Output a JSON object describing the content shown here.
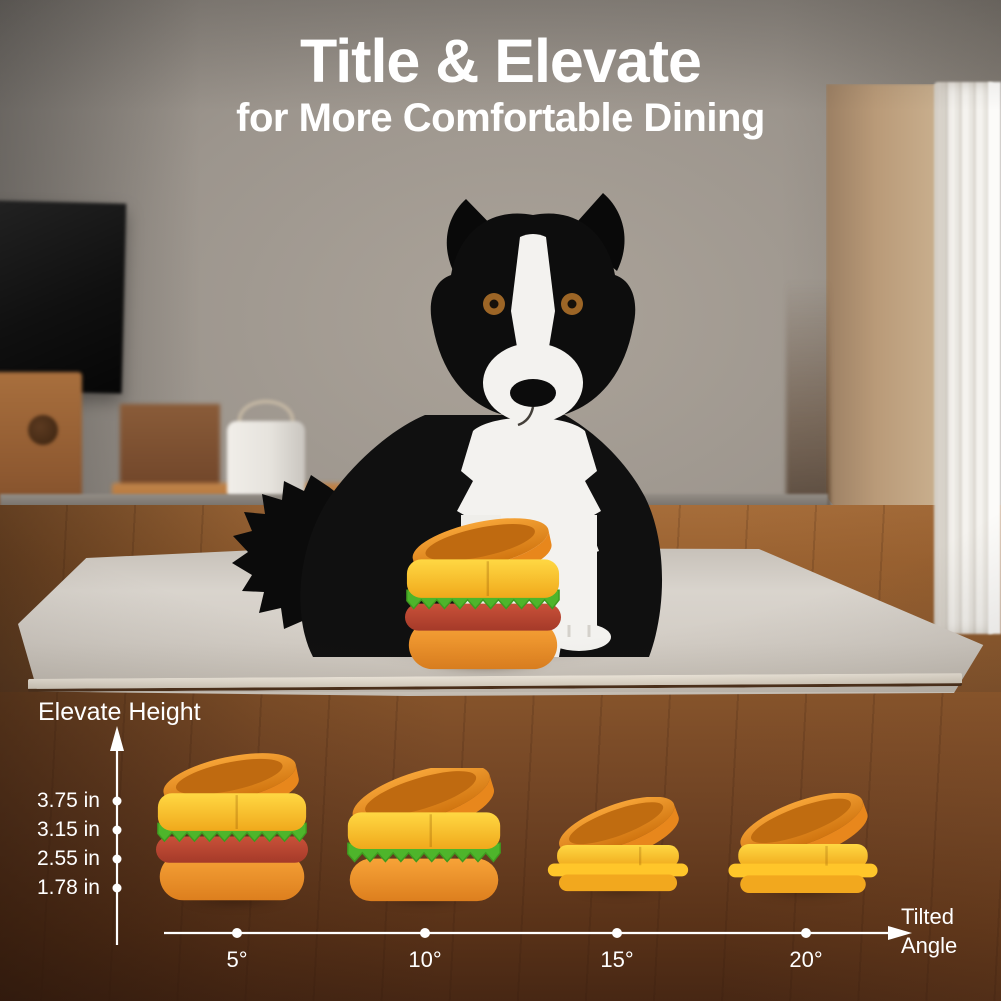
{
  "page": {
    "title": "Title & Elevate",
    "subtitle": "for More Comfortable Dining"
  },
  "chart": {
    "ylabel": "Elevate Height",
    "xlabel_line1": "Tilted",
    "xlabel_line2": "Angle",
    "y_ticks": [
      "3.75 in",
      "3.15 in",
      "2.55 in",
      "1.78 in"
    ],
    "x_ticks": [
      "5°",
      "10°",
      "15°",
      "20°"
    ]
  },
  "chart_data": {
    "type": "scatter",
    "title": "Elevate Height vs Tilted Angle of hamburger-shaped elevated dog bowl",
    "xlabel": "Tilted Angle",
    "ylabel": "Elevate Height",
    "x_categories": [
      "5°",
      "10°",
      "15°",
      "20°"
    ],
    "y_tick_labels": [
      "3.75 in",
      "3.15 in",
      "2.55 in",
      "1.78 in"
    ],
    "points": [
      {
        "tilted_angle": "5°",
        "elevate_height_in": 3.75,
        "bowl_style": "burger with lettuce and patty"
      },
      {
        "tilted_angle": "10°",
        "elevate_height_in": 3.15,
        "bowl_style": "burger with lettuce"
      },
      {
        "tilted_angle": "15°",
        "elevate_height_in": 2.55,
        "bowl_style": "plain yellow tilted bowl"
      },
      {
        "tilted_angle": "20°",
        "elevate_height_in": 1.78,
        "bowl_style": "plain yellow tilted bowl"
      }
    ],
    "axis_color": "#ffffff",
    "legend": "none",
    "grid": false
  },
  "scene": {
    "subject": "black and white Border Collie dog sitting on a light rug",
    "product": "hamburger-shaped tilted elevated dog bowl",
    "objects": [
      "tv-screen",
      "wooden-sideboard",
      "wooden-bench",
      "white-planter-pot",
      "sheer-curtain",
      "window-light",
      "area-rug",
      "wood-floor"
    ]
  },
  "colors": {
    "text": "#ffffff",
    "bun_yellow": "#ffd23a",
    "bowl_orange": "#f09a2a",
    "lettuce_green": "#4eb52b",
    "patty_red": "#bf4a33",
    "rug": "#d6d1c9",
    "floor": "#8a5a2f"
  }
}
